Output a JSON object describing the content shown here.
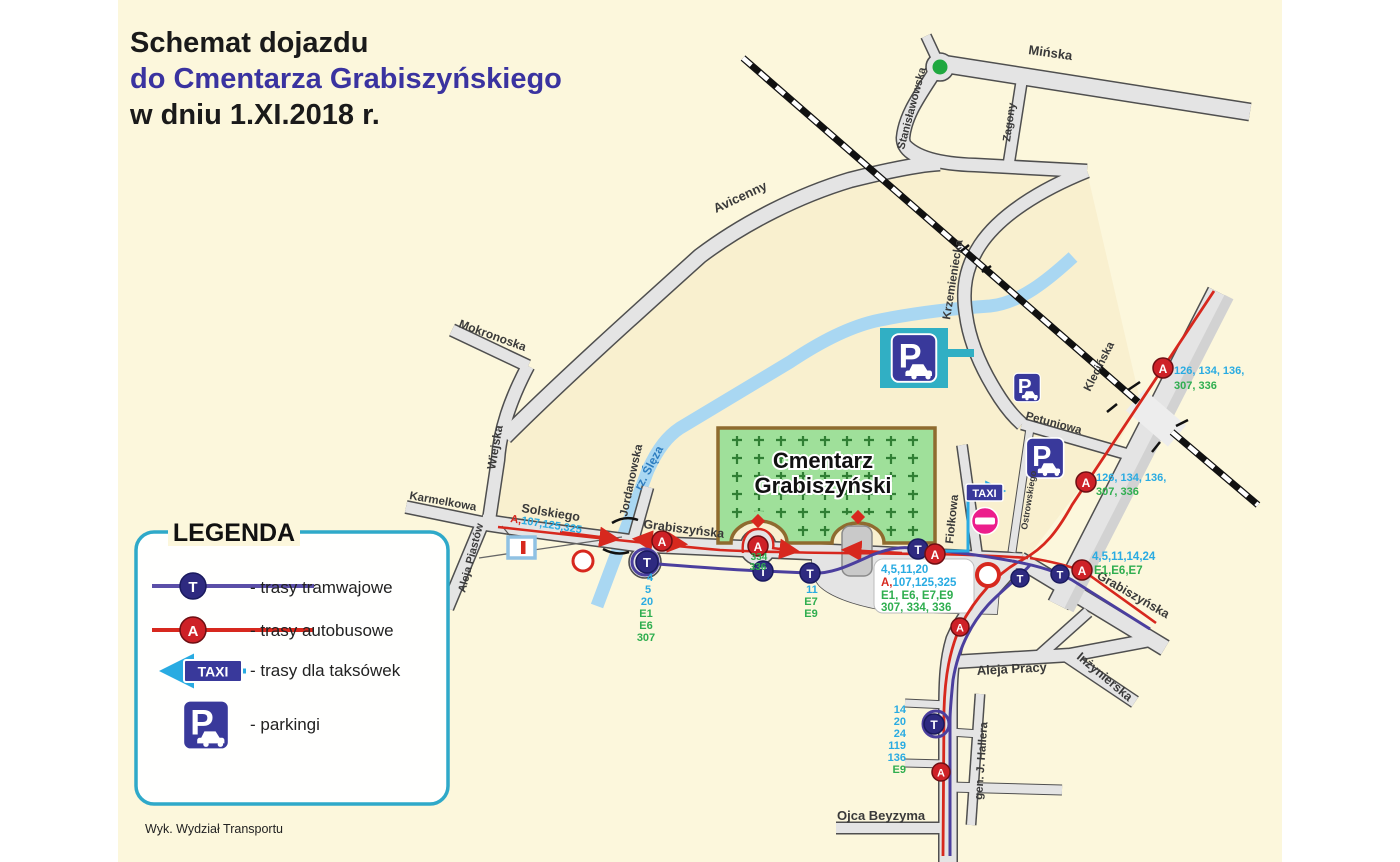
{
  "title": {
    "line1": "Schemat dojazdu",
    "line2": "do Cmentarza Grabiszyńskiego",
    "line3": "w  dniu 1.XI.2018 r."
  },
  "credit": "Wyk. Wydział Transportu",
  "legend": {
    "title": "LEGENDA",
    "tram_label": "- trasy tramwajowe",
    "bus_label": "- trasy autobusowe",
    "taxi_label": "- trasy dla taksówek",
    "parking_label": "- parkingi"
  },
  "symbols": {
    "tram": "T",
    "bus": "A",
    "parking": "P",
    "taxi": "TAXI"
  },
  "colors": {
    "tram": "#4B3F9E",
    "bus": "#D7281E",
    "taxi": "#29ABE2",
    "parking_sign": "#39399B",
    "route_cyan": "#29ABE2",
    "route_green": "#2FAE4F",
    "title_accent": "#3A33A0",
    "cemetery_green": "#9FE09A",
    "map_bg": "#FCF7DC"
  },
  "map": {
    "cemetery": {
      "line1": "Cmentarz",
      "line2": "Grabiszyński"
    },
    "streets": [
      "Mińska",
      "Stanisławowska",
      "Zagony",
      "Avicenny",
      "Mokronoska",
      "Wiejska",
      "Karmelkowa",
      "Aleja Piastów",
      "Solskiego",
      "Jordanowska",
      "rz. Ślęza",
      "Grabiszyńska",
      "Grabiszyńska",
      "Krzemieniecka",
      "Petuniowa",
      "Fiołkowa",
      "Ostrowskiego",
      "Klecińska",
      "Aleja Pracy",
      "Inżynierska",
      "gen. J. Hallera",
      "Ojca Beyzyma"
    ],
    "route_labels": {
      "solskiego_prefix": "A,",
      "solskiego_numbers": "107,125,325",
      "west_loop": [
        "4",
        "5",
        "20",
        "E1",
        "E6",
        "307"
      ],
      "mid_stop": [
        "11",
        "E7",
        "E9"
      ],
      "gate_stop": [
        "334",
        "336"
      ],
      "central_box": {
        "l1": "4,5,11,20",
        "l2_prefix": "A,",
        "l2": "107,125,325",
        "l3": "E1, E6, E7,E9",
        "l4": "307, 334, 336"
      },
      "junction_se": {
        "l1": "4,5,11,14,24",
        "l2": "E1,E6,E7"
      },
      "klecinska_upper": {
        "l1": "126, 134, 136,",
        "l2": "307, 336"
      },
      "klecinska_lower": {
        "l1": "126, 134, 136,",
        "l2": "307, 336"
      },
      "south": [
        "14",
        "20",
        "24",
        "119",
        "136",
        "E9"
      ]
    }
  }
}
